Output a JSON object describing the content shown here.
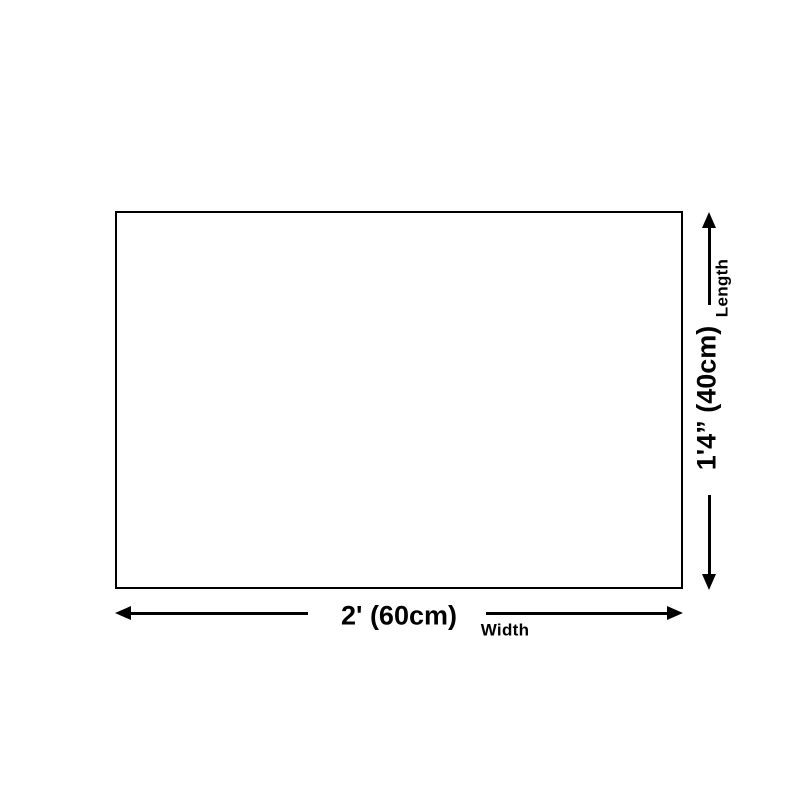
{
  "colors": {
    "ink": "#000000",
    "bg": "#ffffff"
  },
  "diagram": {
    "type": "size-guide",
    "shape": "rectangle",
    "width": {
      "label": "2' (60cm)",
      "caption": "Width"
    },
    "length": {
      "label": "1'4” (40cm)",
      "caption": "Length"
    }
  }
}
